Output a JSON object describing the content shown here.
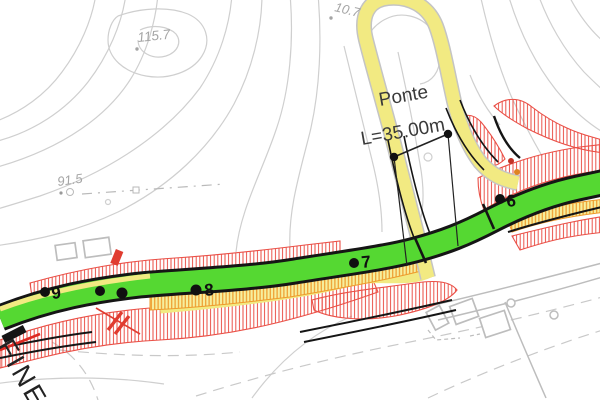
{
  "canvas": {
    "width": 600,
    "height": 400
  },
  "bridge": {
    "name": "Ponte",
    "length": "L=35.00m"
  },
  "elevations": {
    "e1": "115.7",
    "e2": "91.5",
    "e3": "10.7"
  },
  "markers": [
    {
      "label": "6"
    },
    {
      "label": "7"
    },
    {
      "label": "8"
    },
    {
      "label": "9"
    }
  ],
  "end_label": "FINE",
  "colors": {
    "new_road_green": "#55d832",
    "existing_road_yellow": "#f2ea82",
    "slope_hatch_red": "#ea5047",
    "fill_hatch_orange": "#ee9b2c",
    "contour_gray": "#cfcfcf",
    "edge_black": "#151515"
  }
}
